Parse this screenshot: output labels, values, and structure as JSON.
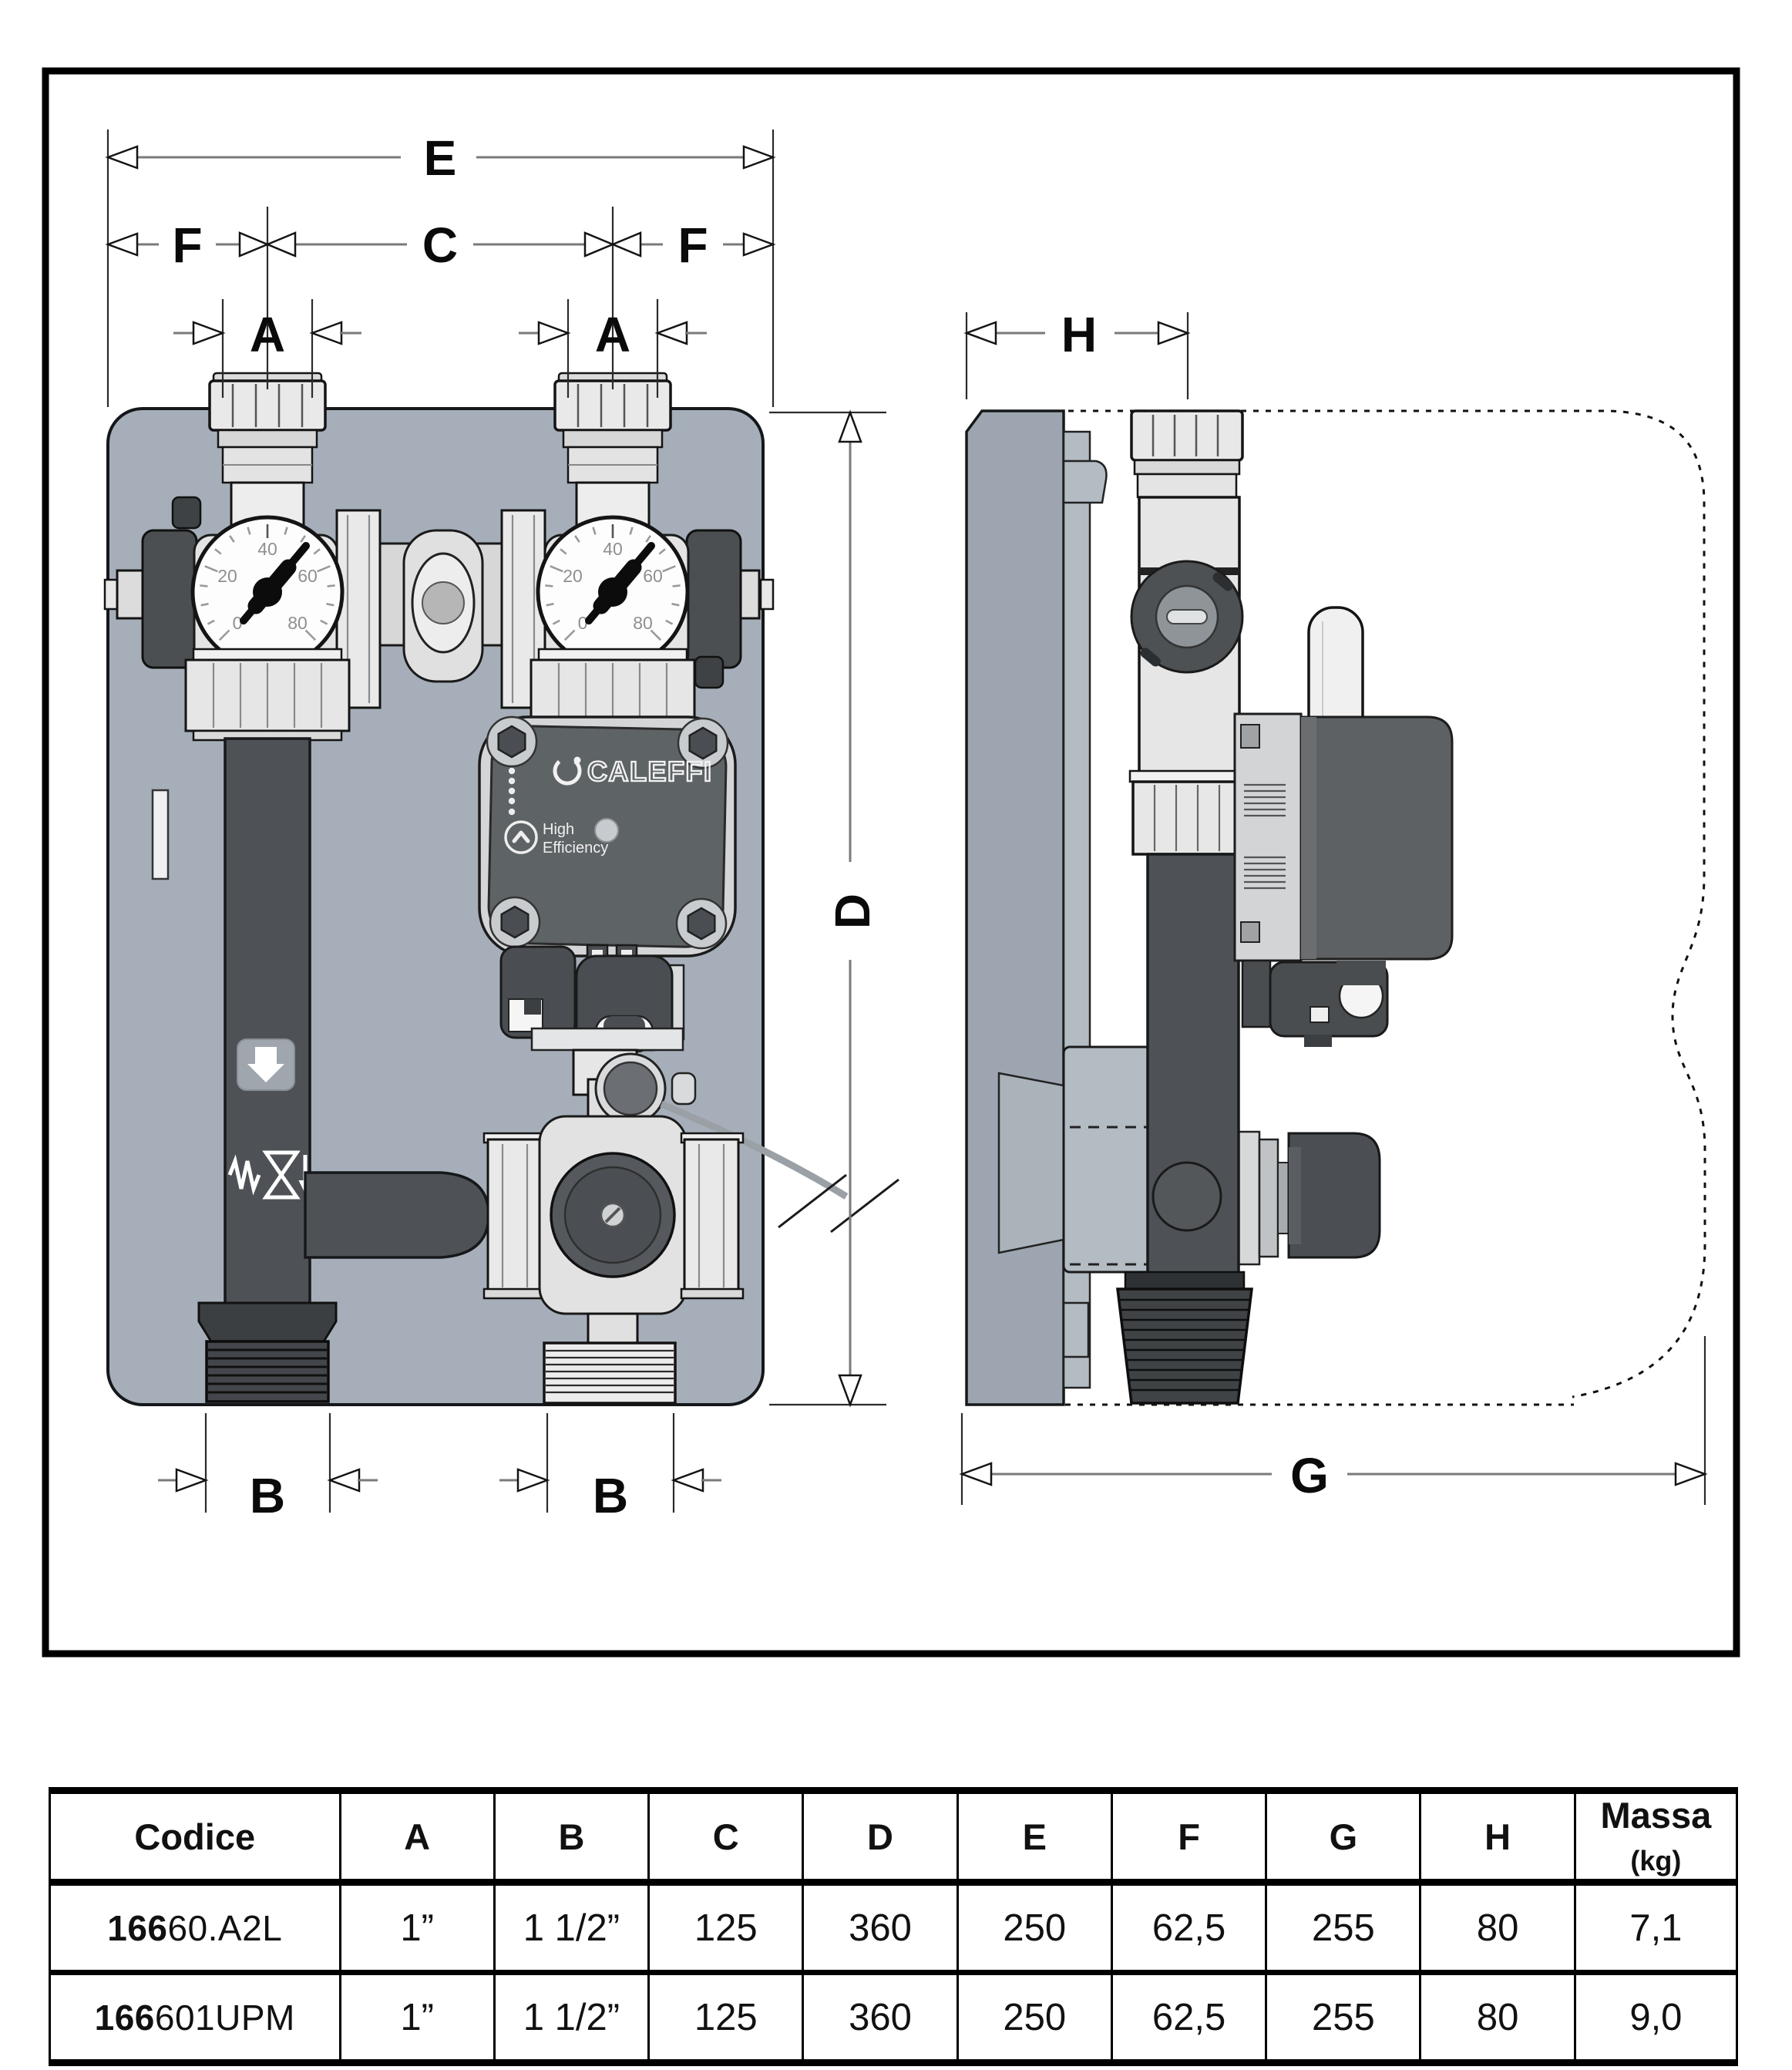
{
  "dims": {
    "a": "A",
    "b": "B",
    "c": "C",
    "d": "D",
    "e": "E",
    "f": "F",
    "g": "G",
    "h": "H"
  },
  "front_view": {
    "gauge_ticks": [
      "0",
      "20",
      "40",
      "60",
      "80"
    ],
    "pump": {
      "brand": "CALEFFI",
      "badge_top": "High",
      "badge_bottom": "Efficiency"
    }
  },
  "table": {
    "codice_header": "Codice",
    "dim_headers": [
      "A",
      "B",
      "C",
      "D",
      "E",
      "F",
      "G",
      "H"
    ],
    "massa_label": "Massa ",
    "massa_unit": "(kg)",
    "rows": [
      {
        "code_bold": "166",
        "code_rest": "60.A2L",
        "values": [
          "1”",
          "1 1/2”",
          "125",
          "360",
          "250",
          "62,5",
          "255",
          "80",
          "7,1"
        ]
      },
      {
        "code_bold": "166",
        "code_rest": "601UPM",
        "values": [
          "1”",
          "1 1/2”",
          "125",
          "360",
          "250",
          "62,5",
          "255",
          "80",
          "9,0"
        ]
      }
    ]
  },
  "colors": {
    "panel": "#a6afb9",
    "side_plate": "#9da6b0",
    "dark_pipe": "#4e5256",
    "metal_light": "#e7e7e7",
    "pump_face": "#5e6366",
    "frame_border": "#000000"
  }
}
